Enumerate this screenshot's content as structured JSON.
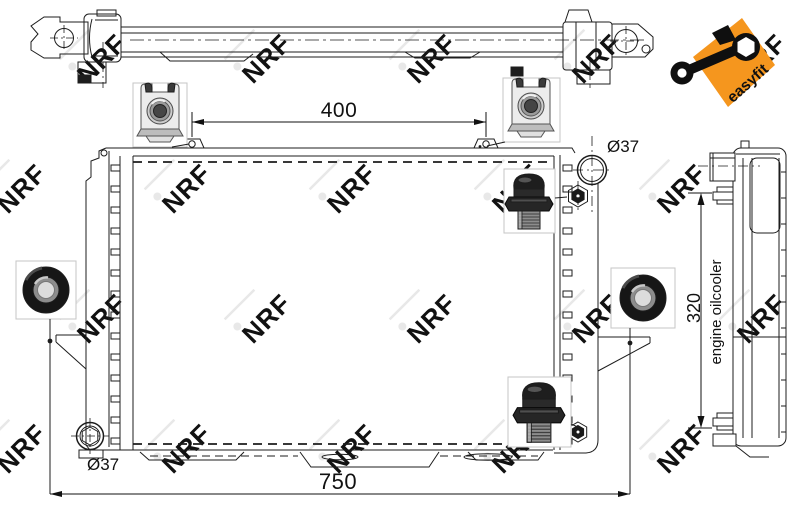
{
  "watermark": {
    "text": "NRF",
    "color": "#e8e8e8"
  },
  "badge": {
    "label": "easyfit",
    "color": "#f5961e",
    "text_color": "#111111"
  },
  "dimensions": {
    "mount_hole_spacing": "400",
    "overall_width": "750",
    "oilcooler_port_spacing": "320",
    "top_port_diameter": "Ø37",
    "bottom_port_diameter": "Ø37"
  },
  "annotations": {
    "oilcooler_note": "engine oilcooler"
  },
  "callouts": {
    "clip_icon": "cage-clip-nut-photo",
    "plug_icon": "drain-plug-photo",
    "grommet_icon": "rubber-grommet-photo"
  }
}
